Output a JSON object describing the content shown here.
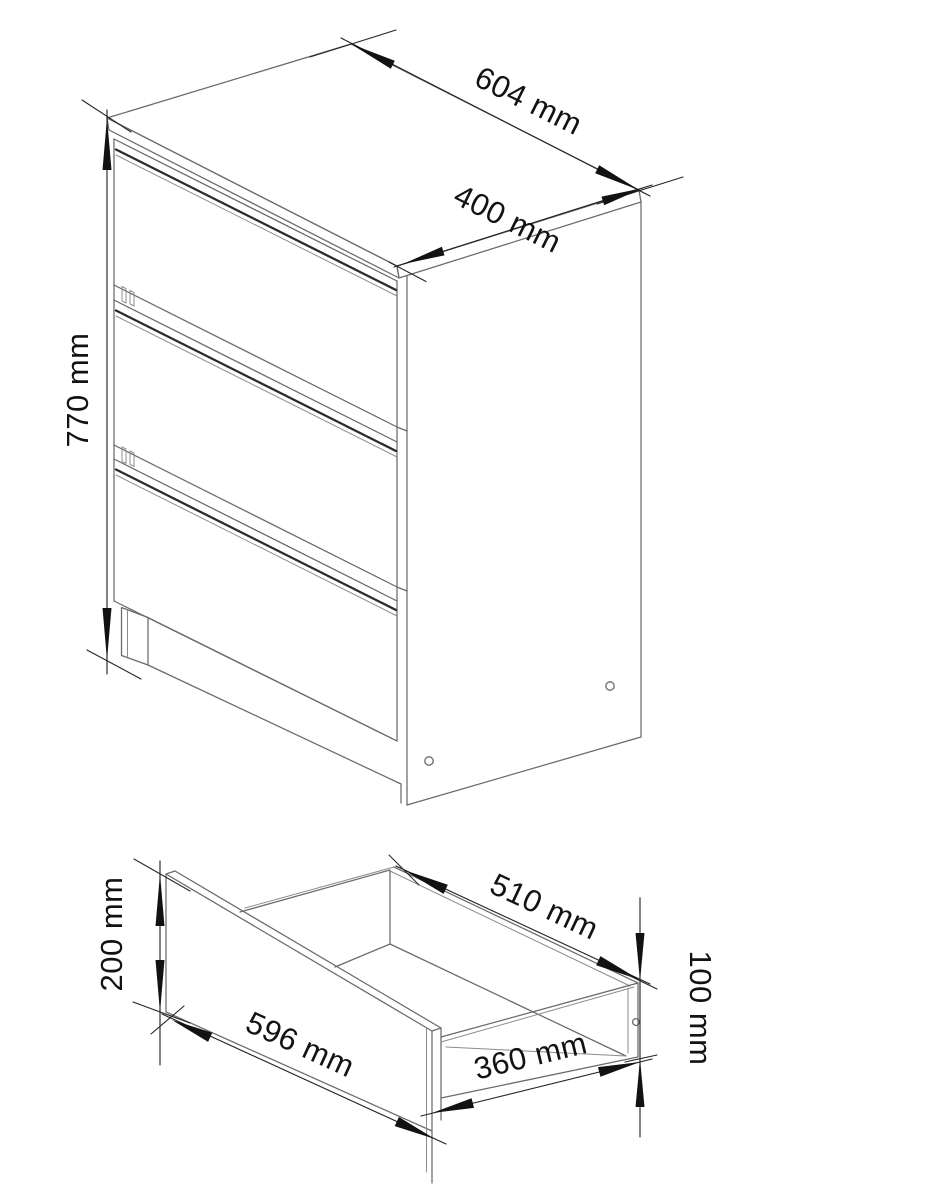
{
  "page": {
    "background": "#ffffff",
    "drawing_line_color": "#6a6a6a",
    "dimension_color": "#121212",
    "groove_accent_color": "#2b2b2b"
  },
  "cabinet_view": {
    "description": "three-drawer cabinet isometric view",
    "labels": {
      "width": "604 mm",
      "depth": "400 mm",
      "height": "770 mm"
    }
  },
  "drawer_view": {
    "description": "single drawer box isometric view",
    "labels": {
      "front_width": "596 mm",
      "front_height": "200 mm",
      "inner_back_width": "510 mm",
      "side_depth": "360 mm",
      "side_height": "100 mm"
    }
  }
}
